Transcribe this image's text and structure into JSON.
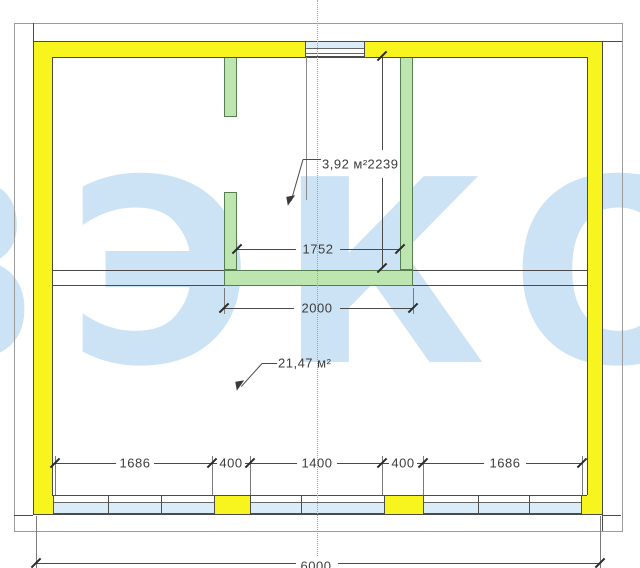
{
  "drawing": {
    "type": "floor-plan",
    "watermark_text": "ВЭКО",
    "rooms": {
      "small_area_label": "3,92 м²",
      "large_area_label": "21,47 м²"
    },
    "dimensions": {
      "inner_room_width": "1752",
      "outer_room_width": "2000",
      "inner_room_height": "2239",
      "bottom": [
        "1686",
        "400",
        "1400",
        "400",
        "1686"
      ],
      "overall_width": "6000"
    },
    "colors": {
      "exterior_wall": "#f7f41e",
      "partition_wall": "#bce5b0",
      "window_glass": "#d9ecf7",
      "watermark": "#cbe3f4"
    }
  }
}
